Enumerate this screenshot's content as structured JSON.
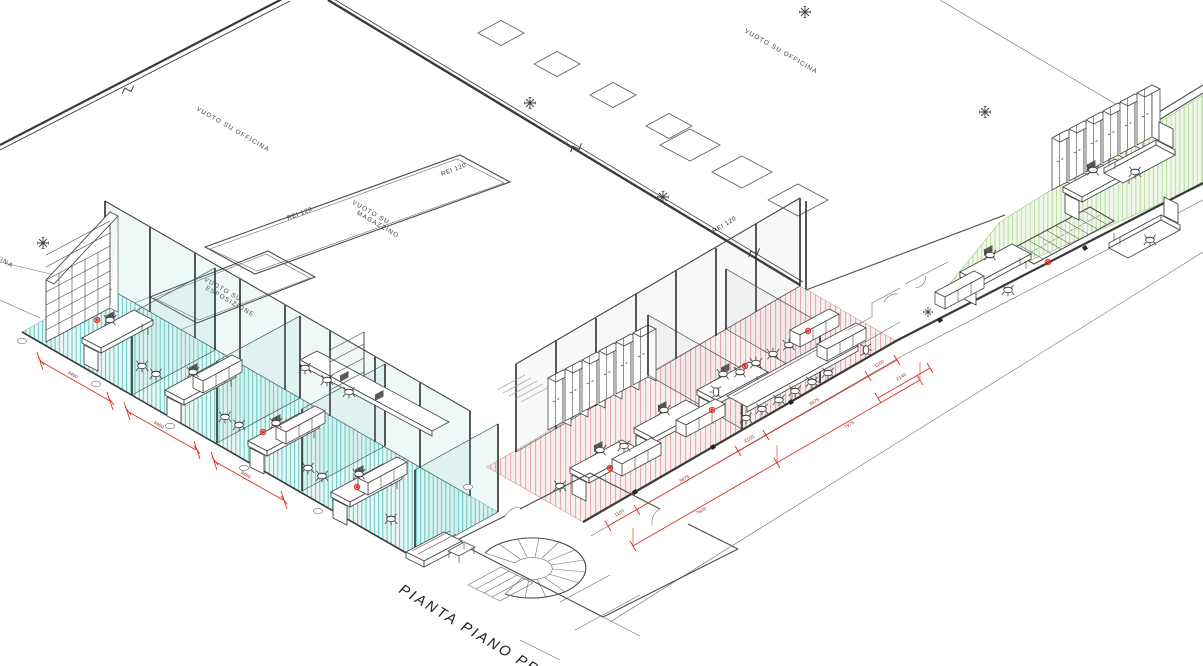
{
  "drawing": {
    "title": "PIANTA PIANO PRIMO",
    "labels": {
      "void_officina": "VUOTO SU OFFICINA",
      "void_magazzino_1": "VUOTO SU",
      "void_magazzino_2": "MAGAZZINO",
      "void_esposizione_1": "VUOTO SU",
      "void_esposizione_2": "ESPOSIZIONE",
      "fire_rating": "REI 120"
    },
    "dimensions": {
      "teal": [
        "3460",
        "3460",
        "3460"
      ],
      "pink_inner": [
        "1100",
        "3875",
        "1100",
        "3875",
        "1100"
      ],
      "pink_outer": [
        "7800",
        "7975"
      ],
      "pink_right": "2140"
    },
    "colors": {
      "teal_hatch": "#5fc7c0",
      "teal_bg": "#e9f7f5",
      "pink_hatch": "#dfa9ab",
      "pink_bg": "#f9efef",
      "green_hatch": "#b7dd9e",
      "green_bg": "#f1f8ea",
      "dimension_red": "#d93025",
      "wall": "#3a3a3a"
    }
  }
}
